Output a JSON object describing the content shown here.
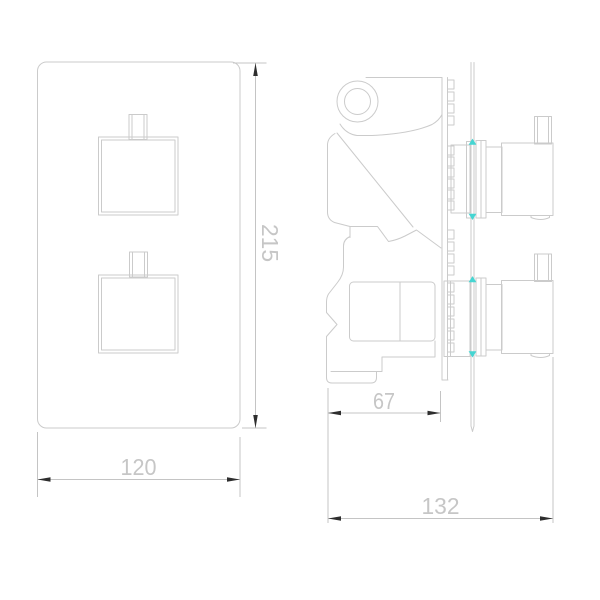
{
  "drawing": {
    "type": "thermostatic shower valve - 2D CAD dimension drawing",
    "views": {
      "front_view": "faceplate with two square handles",
      "side_view": "valve body behind wall plane with two knobs"
    },
    "dimensions": {
      "plate_height": {
        "value": "215",
        "orientation": "vertical",
        "view": "front"
      },
      "plate_width": {
        "value": "120",
        "orientation": "horizontal",
        "view": "front"
      },
      "body_depth": {
        "value": "67",
        "orientation": "horizontal",
        "view": "side"
      },
      "overall_depth": {
        "value": "132",
        "orientation": "horizontal",
        "view": "side"
      }
    }
  },
  "colors": {
    "background": "#ffffff",
    "outline": "#cbcbcb",
    "dimension": "#c4c4c4",
    "dimtext": "#c6c6c6",
    "arrow": "#2e2e2e",
    "marker": "#45d5d2"
  }
}
